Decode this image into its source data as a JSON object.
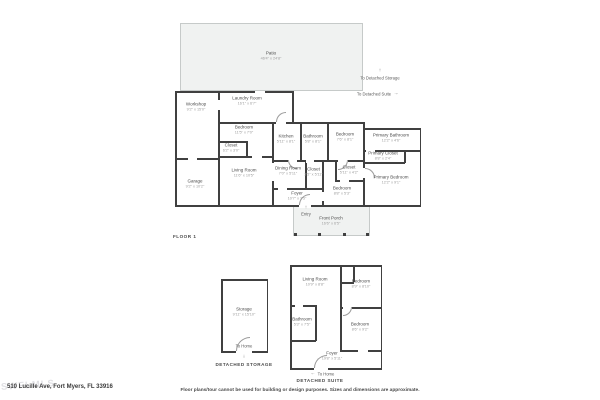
{
  "floor1": {
    "caption": "FLOOR 1",
    "patio": {
      "name": "Patio",
      "dims": "46'4\" x 24'8\""
    },
    "workshop": {
      "name": "Workshop",
      "dims": "9'2\" x 15'0\""
    },
    "garage": {
      "name": "Garage",
      "dims": "9'2\" x 10'2\""
    },
    "laundry": {
      "name": "Laundry Room",
      "dims": "16'1\" x 6'7\""
    },
    "bedroom1": {
      "name": "Bedroom",
      "dims": "11'5\" x 7'0\""
    },
    "closet1": {
      "name": "Closet",
      "dims": "6'2\" x 3'0\""
    },
    "living": {
      "name": "Living Room",
      "dims": "11'6\" x 10'5\""
    },
    "kitchen": {
      "name": "Kitchen",
      "dims": "5'11\" x 8'1\""
    },
    "bathroom1": {
      "name": "Bathroom",
      "dims": "5'8\" x 8'1\""
    },
    "dining": {
      "name": "Dining Room",
      "dims": "7'0\" x 5'11\""
    },
    "closet2": {
      "name": "Closet",
      "dims": "3'5\" x 5'11\""
    },
    "foyer": {
      "name": "Foyer",
      "dims": "10'7\" x 3'5\""
    },
    "bedroom2": {
      "name": "Bedroom",
      "dims": "7'6\" x 8'1\""
    },
    "closet3": {
      "name": "Closet",
      "dims": "5'11\" x 4'2\""
    },
    "bedroom3": {
      "name": "Bedroom",
      "dims": "8'8\" x 5'3\""
    },
    "primary_bathroom": {
      "name": "Primary Bathroom",
      "dims": "12'2\" x 4'6\""
    },
    "primary_closet": {
      "name": "Primary Closet",
      "dims": "8'8\" x 2'4\""
    },
    "primary_bedroom": {
      "name": "Primary Bedroom",
      "dims": "12'2\" x 9'1\""
    },
    "front_porch": {
      "name": "Front Porch",
      "dims": "16'6\" x 6'5\""
    },
    "entry": "Entry",
    "to_detached_storage": "To Detached Storage",
    "to_detached_suite": "To Detached Suite"
  },
  "detached_storage": {
    "caption": "DETACHED STORAGE",
    "storage": {
      "name": "Storage",
      "dims": "9'11\" x 15'10\""
    },
    "to_home": "To Home"
  },
  "detached_suite": {
    "caption": "DETACHED SUITE",
    "living": {
      "name": "Living Room",
      "dims": "10'9\" x 8'8\""
    },
    "bedroom_a": {
      "name": "Bedroom",
      "dims": "8'9\" x 8'10\""
    },
    "bathroom": {
      "name": "Bathroom",
      "dims": "5'3\" x 7'5\""
    },
    "bedroom_b": {
      "name": "Bedroom",
      "dims": "8'6\" x 9'2\""
    },
    "foyer": {
      "name": "Foyer",
      "dims": "19'8\" x 5'11\""
    },
    "to_home": "To Home"
  },
  "icons": {
    "up_arrow": "↑",
    "down_arrow": "↓",
    "left_arrow": "←",
    "right_arrow": "→"
  },
  "footer": {
    "address": "510 Lucille Ave, Fort Myers, FL 33916",
    "disclaimer": "Floor plans/tour cannot be used for building or design purposes. Sizes and dimensions are approximate.",
    "watermark": "SWFLMLS"
  },
  "colors": {
    "wall": "#404040",
    "outdoor_fill": "#f0f2f1",
    "outdoor_border": "#c6cac9",
    "room_text": "#4d4d4d",
    "dim_text": "#9c9c9c"
  }
}
